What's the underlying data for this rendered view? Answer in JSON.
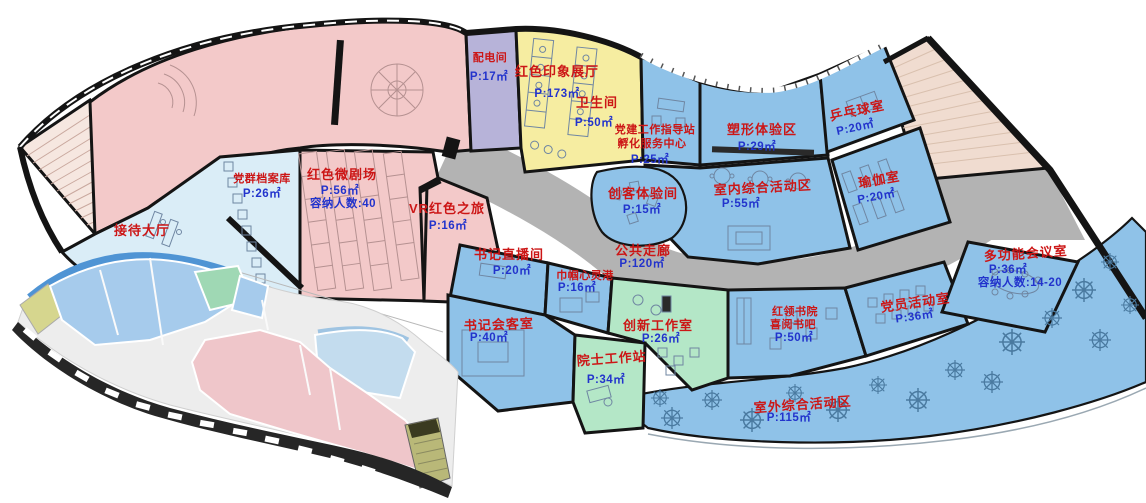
{
  "colors": {
    "room_pink": "#f3c9c9",
    "room_blue": "#8fc2e8",
    "room_pale_blue": "#daedf7",
    "room_lavender": "#b7b3d9",
    "room_yellow": "#f6eda1",
    "room_green": "#b4e7c7",
    "corridor_gray": "#b3b3b3",
    "stair_beige": "#f0dcd0",
    "stair_pink": "#f6e7e0",
    "wall_black": "#141414",
    "label_red": "#cc1616",
    "label_blue": "#2233cc"
  },
  "rooms": [
    {
      "id": "exhibition-hall",
      "name": "红色印象展厅",
      "area": "P:173㎡"
    },
    {
      "id": "power-room",
      "name": "配电间",
      "area": "P:17㎡"
    },
    {
      "id": "restroom",
      "name": "卫生间",
      "area": "P:50㎡"
    },
    {
      "id": "party-guidance-station",
      "name": "党建工作指导站",
      "name2": "孵化服务中心",
      "area": "P:25㎡"
    },
    {
      "id": "body-shaping-zone",
      "name": "塑形体验区",
      "area": "P:29㎡"
    },
    {
      "id": "table-tennis-room",
      "name": "乒乓球室",
      "area": "P:20㎡"
    },
    {
      "id": "yoga-room",
      "name": "瑜伽室",
      "area": "P:20㎡"
    },
    {
      "id": "indoor-activity-zone",
      "name": "室内综合活动区",
      "area": "P:55㎡"
    },
    {
      "id": "maker-experience-room",
      "name": "创客体验间",
      "area": "P:15㎡"
    },
    {
      "id": "party-archives",
      "name": "党群档案库",
      "area": "P:26㎡"
    },
    {
      "id": "red-micro-theater",
      "name": "红色微剧场",
      "area": "P:56㎡",
      "capacity": "容纳人数:40"
    },
    {
      "id": "vr-red-journey",
      "name": "VR红色之旅",
      "area": "P:16㎡"
    },
    {
      "id": "reception-hall",
      "name": "接待大厅"
    },
    {
      "id": "secretary-livestream-room",
      "name": "书记直播间",
      "area": "P:20㎡"
    },
    {
      "id": "womens-harbor",
      "name": "巾帼心灵港",
      "area": "P:16㎡"
    },
    {
      "id": "public-corridor",
      "name": "公共走廊",
      "area": "P:120㎡"
    },
    {
      "id": "secretary-meeting-room",
      "name": "书记会客室",
      "area": "P:40㎡"
    },
    {
      "id": "innovation-studio",
      "name": "创新工作室",
      "area": "P:26㎡"
    },
    {
      "id": "academician-workstation",
      "name": "院士工作站",
      "area": "P:34㎡"
    },
    {
      "id": "red-collar-academy",
      "name": "红领书院",
      "name2": "喜阅书吧",
      "area": "P:50㎡"
    },
    {
      "id": "party-member-room",
      "name": "党员活动室",
      "area": "P:36㎡"
    },
    {
      "id": "multifunction-meeting-room",
      "name": "多功能会议室",
      "area": "P:36㎡",
      "capacity": "容纳人数:14-20"
    },
    {
      "id": "outdoor-activity-zone",
      "name": "室外综合活动区",
      "area": "P:115㎡"
    }
  ]
}
